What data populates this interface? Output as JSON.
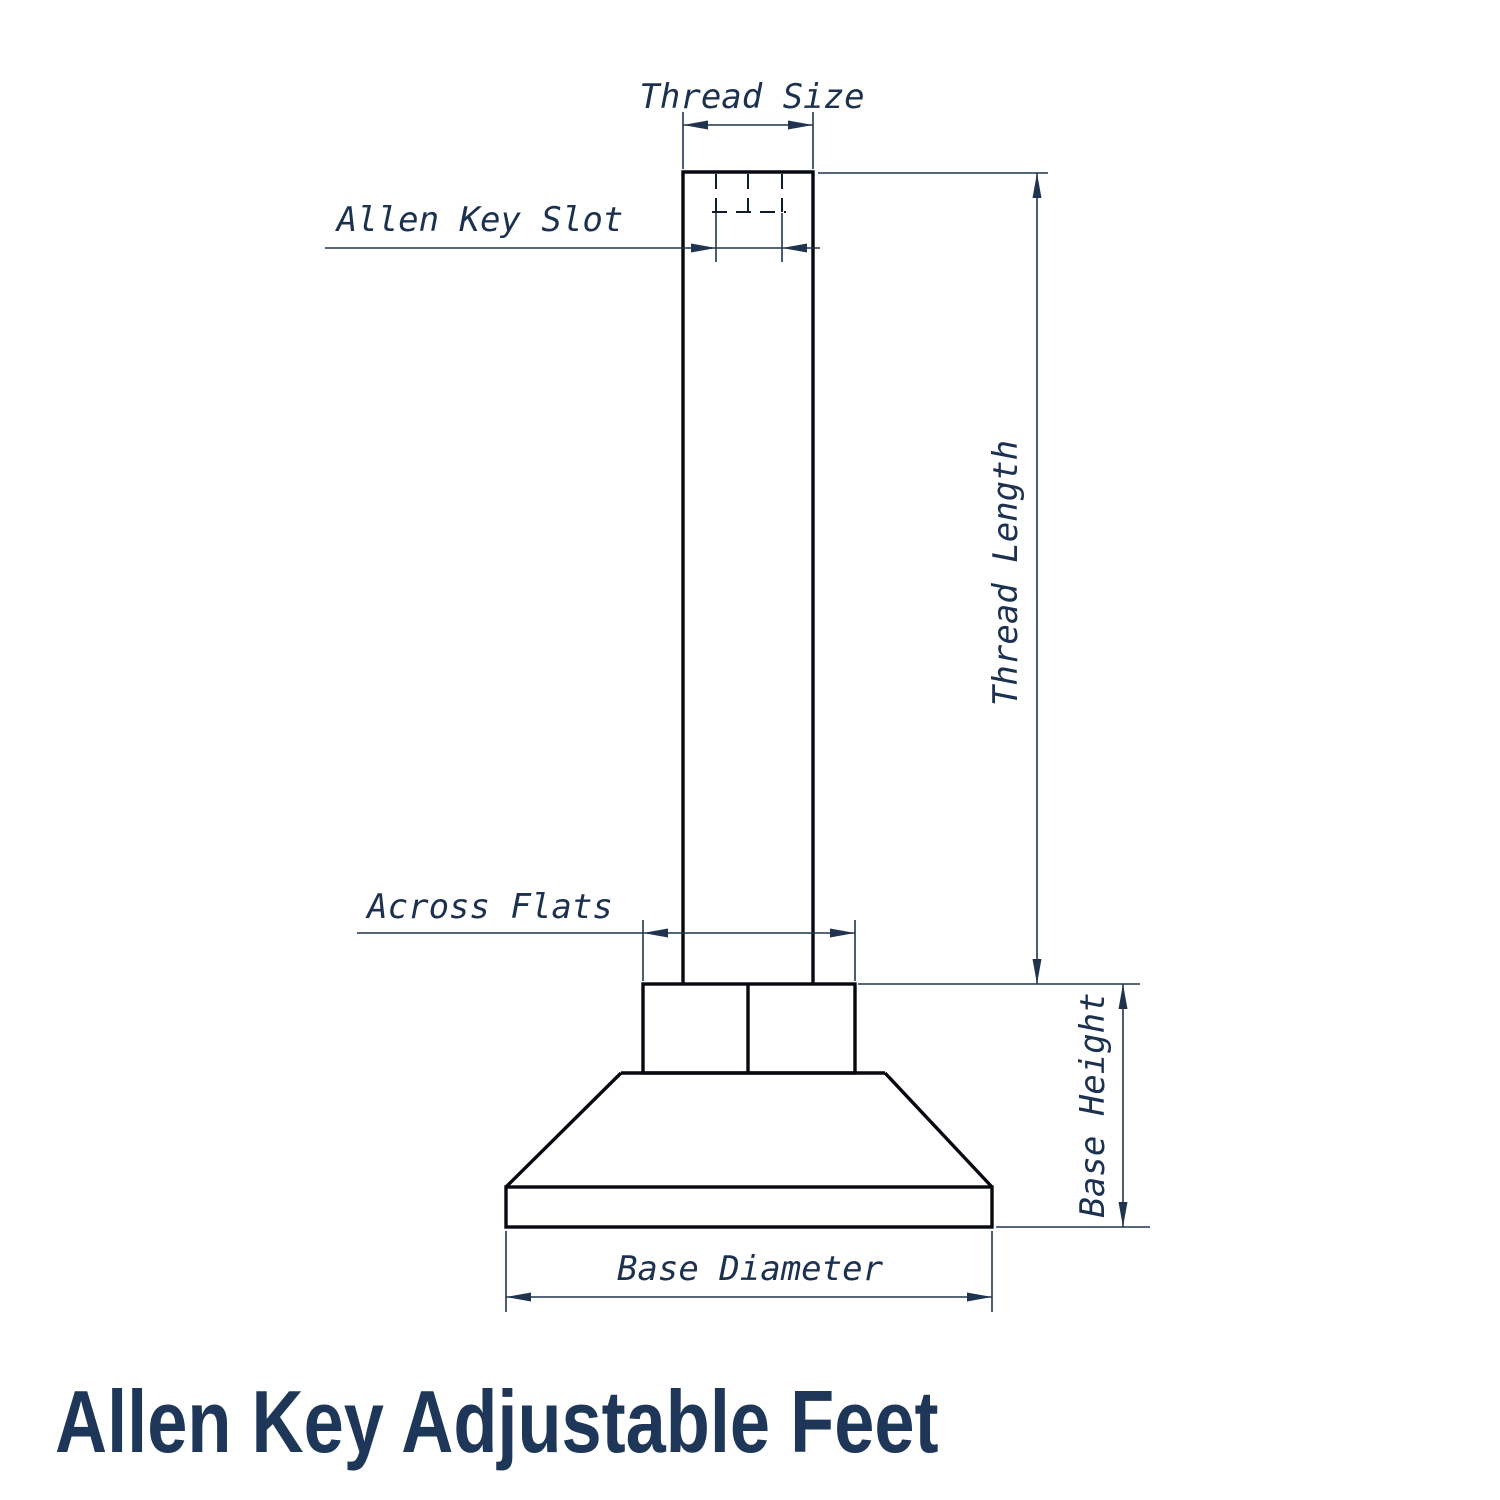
{
  "page": {
    "title": "Allen Key Adjustable Feet",
    "background": "#ffffff"
  },
  "diagram": {
    "type": "technical-dimension-drawing",
    "labels": {
      "thread_size": "Thread Size",
      "allen_key_slot": "Allen Key Slot",
      "thread_length": "Thread Length",
      "across_flats": "Across Flats",
      "base_height": "Base Height",
      "base_diameter": "Base Diameter"
    },
    "colors": {
      "outline": "#06090f",
      "dimension_line": "#20344f",
      "hidden_line": "#101c2b",
      "label_text": "#1c3150",
      "title_text": "#1e3657"
    }
  }
}
